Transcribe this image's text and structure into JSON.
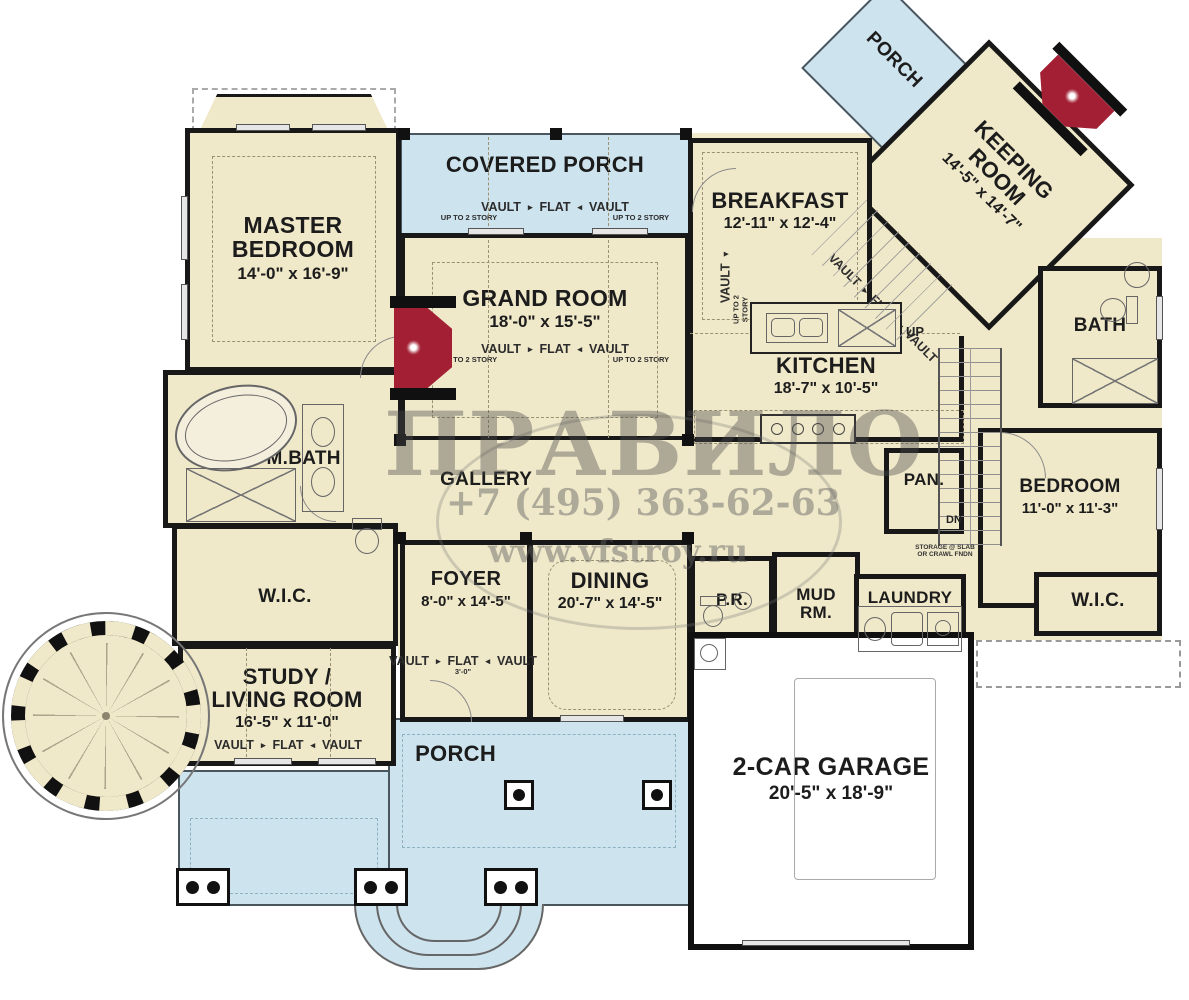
{
  "watermark": {
    "brand": "ПРАВИЛО",
    "phone": "+7 (495) 363-62-63",
    "site": "www.vfstroy.ru"
  },
  "labels": {
    "up": "UP",
    "dn": "DN",
    "storage": "STORAGE @ SLAB OR CRAWL FNDN"
  },
  "vault": {
    "vault": "VAULT",
    "flat": "FLAT",
    "up_to": "UP TO 2 STORY",
    "arr_r": "▸",
    "arr_l": "◂",
    "arr_d": "▾"
  },
  "colors": {
    "floor": "#efe8c9",
    "porch": "#cde3ee",
    "wall": "#181818",
    "fireplace": "#a31f34",
    "garage": "#ffffff"
  },
  "rooms": [
    {
      "id": "base-central",
      "base": true,
      "x": 398,
      "y": 133,
      "w": 570,
      "h": 525
    },
    {
      "id": "base-right",
      "base": true,
      "x": 940,
      "y": 238,
      "w": 222,
      "h": 402
    },
    {
      "id": "porch-left",
      "porch": true,
      "x": 178,
      "y": 770,
      "w": 212,
      "h": 136,
      "label": ""
    },
    {
      "id": "porch-bottom",
      "porch": true,
      "x": 388,
      "y": 718,
      "w": 302,
      "h": 188,
      "size": "xl",
      "ly": 12,
      "lx": 0,
      "lw": 44,
      "label": "PORCH"
    },
    {
      "id": "porch-top",
      "porch": true,
      "x": 826,
      "y": 8,
      "w": 120,
      "h": 120,
      "rot": 45,
      "size": "lg",
      "ly": 32,
      "label": "PORCH"
    },
    {
      "id": "covered-porch",
      "porch": true,
      "x": 400,
      "y": 133,
      "w": 290,
      "h": 102,
      "size": "xl",
      "ly": 18,
      "label": "COVERED PORCH"
    },
    {
      "id": "keeping",
      "x": 886,
      "y": 82,
      "w": 206,
      "h": 206,
      "rot": 45,
      "size": "xl",
      "ly": 26,
      "label": "KEEPING\nROOM",
      "dim": "14'-5\" x 14'-7\""
    },
    {
      "id": "master",
      "x": 185,
      "y": 128,
      "w": 216,
      "h": 244,
      "size": "xl",
      "ly": 34,
      "label": "MASTER\nBEDROOM",
      "dim": "14'-0\" x 16'-9\""
    },
    {
      "id": "grand",
      "x": 400,
      "y": 233,
      "w": 290,
      "h": 208,
      "size": "xl",
      "ly": 24,
      "label": "GRAND ROOM",
      "dim": "18'-0\" x 15'-5\""
    },
    {
      "id": "breakfast",
      "cls": "no-bottom",
      "x": 688,
      "y": 138,
      "w": 184,
      "h": 198,
      "size": "xl",
      "ly": 24,
      "label": "BREAKFAST",
      "dim": "12'-11\" x 12'-4\""
    },
    {
      "id": "bath",
      "x": 1038,
      "y": 266,
      "w": 124,
      "h": 142,
      "size": "lg",
      "ly": 34,
      "label": "BATH"
    },
    {
      "id": "kitchen",
      "cls": "no-top",
      "x": 688,
      "y": 336,
      "w": 276,
      "h": 106,
      "size": "xl",
      "ly": 18,
      "label": "KITCHEN",
      "dim": "18'-7\" x 10'-5\""
    },
    {
      "id": "pan",
      "x": 884,
      "y": 448,
      "w": 80,
      "h": 86,
      "size": "md",
      "ly": 24,
      "label": "PAN."
    },
    {
      "id": "bedroom",
      "x": 978,
      "y": 428,
      "w": 184,
      "h": 180,
      "size": "lg",
      "ly": 26,
      "label": "BEDROOM",
      "dim": "11'-0\" x 11'-3\""
    },
    {
      "id": "mbath",
      "x": 163,
      "y": 370,
      "w": 240,
      "h": 158,
      "size": "lg",
      "ly": 50,
      "lx": 18,
      "lw": 82,
      "label": "M.BATH"
    },
    {
      "id": "gallery",
      "cls": "open",
      "x": 398,
      "y": 440,
      "w": 294,
      "h": 100,
      "size": "lg",
      "ly": 30,
      "lx": 0,
      "lw": 60,
      "label": "GALLERY"
    },
    {
      "id": "wic-left",
      "x": 172,
      "y": 524,
      "w": 226,
      "h": 122,
      "size": "lg",
      "ly": 52,
      "label": "W.I.C."
    },
    {
      "id": "foyer",
      "x": 400,
      "y": 540,
      "w": 132,
      "h": 182,
      "size": "lg",
      "ly": 14,
      "label": "FOYER",
      "dim": "8'-0\" x 14'-5\""
    },
    {
      "id": "dining",
      "x": 528,
      "y": 540,
      "w": 164,
      "h": 182,
      "size": "xl",
      "ly": 14,
      "label": "DINING",
      "dim": "20'-7\" x 14'-5\""
    },
    {
      "id": "pr",
      "x": 690,
      "y": 556,
      "w": 84,
      "h": 84,
      "size": "md",
      "ly": 40,
      "label": "P.R."
    },
    {
      "id": "mud",
      "x": 772,
      "y": 552,
      "w": 88,
      "h": 106,
      "size": "md",
      "ly": 30,
      "label": "MUD\nRM."
    },
    {
      "id": "laundry",
      "x": 854,
      "y": 574,
      "w": 112,
      "h": 84,
      "size": "md",
      "ly": 14,
      "label": "LAUNDRY"
    },
    {
      "id": "wic-right",
      "x": 1034,
      "y": 572,
      "w": 128,
      "h": 64,
      "size": "lg",
      "ly": 26,
      "label": "W.I.C."
    },
    {
      "id": "study",
      "x": 178,
      "y": 644,
      "w": 218,
      "h": 122,
      "size": "xl",
      "ly": 14,
      "label": "STUDY /\nLIVING ROOM",
      "dim": "16'-5\" x 11'-0\""
    },
    {
      "id": "garage",
      "garage": true,
      "x": 688,
      "y": 632,
      "w": 286,
      "h": 318,
      "size": "xl",
      "ly": 38,
      "label": "2-CAR GARAGE",
      "dim": "20'-5\" x 18'-9\""
    }
  ],
  "vault_notes": [
    {
      "x": 426,
      "y": 200,
      "w": 258,
      "subs": [
        "UP TO 2 STORY",
        "",
        "UP TO 2 STORY"
      ]
    },
    {
      "x": 426,
      "y": 342,
      "w": 258,
      "subs": [
        "UP TO 2 STORY",
        "",
        "UP TO 2 STORY"
      ]
    },
    {
      "x": 392,
      "y": 654,
      "w": 142,
      "subs": [
        "",
        "3'-0\"",
        ""
      ]
    },
    {
      "x": 208,
      "y": 738,
      "w": 160,
      "subs": [
        "",
        "",
        ""
      ]
    },
    {
      "x": 770,
      "y": 300,
      "w": 220,
      "rot": 45,
      "subs": [
        "",
        "14'-0\"",
        ""
      ]
    },
    {
      "x": 686,
      "y": 262,
      "w": 96,
      "rot": -90,
      "single": true,
      "subs": [
        "UP TO 2 STORY",
        "",
        ""
      ]
    }
  ]
}
